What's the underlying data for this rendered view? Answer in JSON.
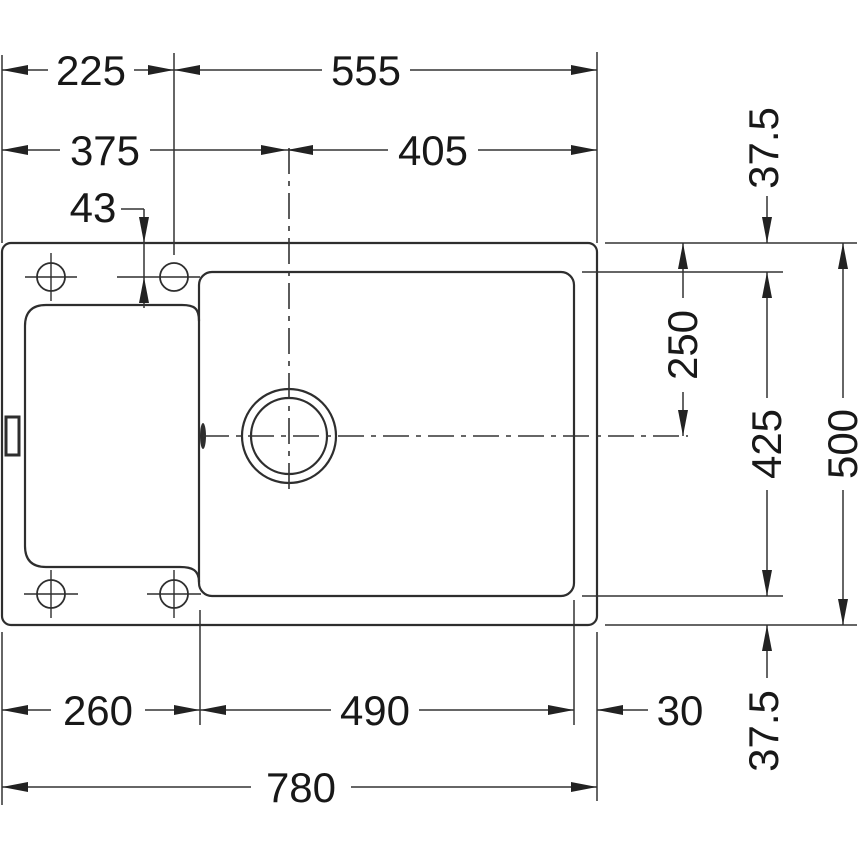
{
  "meta": {
    "drawing_type": "sink-installation-top-view",
    "background_color": "#ffffff",
    "line_color": "#2e2e2e",
    "dimension_line_color": "#333333",
    "text_color": "#181818"
  },
  "dims": {
    "width_left_to_tap_center": "225",
    "width_tap_center_to_right": "555",
    "width_left_to_bowl_center": "375",
    "width_bowl_center_to_right": "405",
    "tap_hole_offset_from_edge": "43",
    "rim_top": "37.5",
    "top_edge_to_bowl_center": "250",
    "bowl_height": "425",
    "overall_depth": "500",
    "drainer_section_width": "260",
    "bowl_width": "490",
    "rim_right": "30",
    "rim_bottom": "37.5",
    "overall_width": "780"
  }
}
